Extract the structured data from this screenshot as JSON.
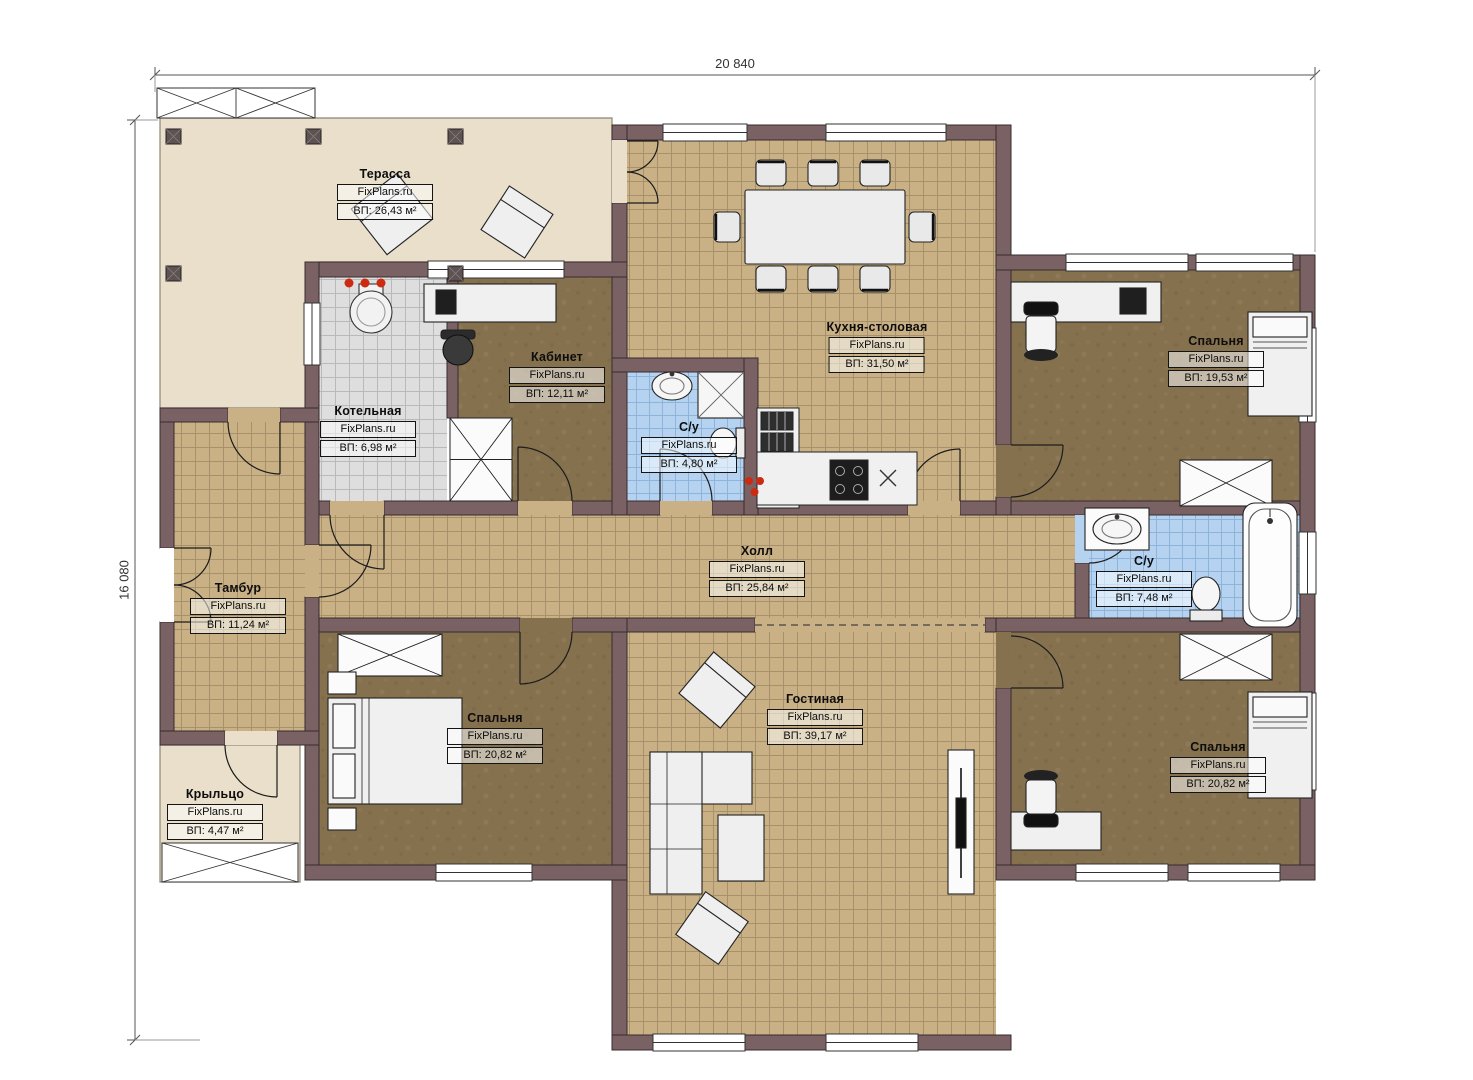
{
  "brand": "FixPlans.ru",
  "dimensions": {
    "width_label": "20 840",
    "height_label": "16 080"
  },
  "palette": {
    "wall": "#7a6164",
    "terrace_floor": "#e9dfcb",
    "tile_floor": "#c9b185",
    "wood_floor": "#86714f",
    "bath_floor": "#b5d3f0",
    "boiler_floor": "#dedede",
    "burner_red": "#cc2b12"
  },
  "rooms": [
    {
      "id": "terrace",
      "name": "Терасса",
      "brand": "FixPlans.ru",
      "area": "ВП: 26,43 м²"
    },
    {
      "id": "boiler",
      "name": "Котельная",
      "brand": "FixPlans.ru",
      "area": "ВП: 6,98 м²"
    },
    {
      "id": "office",
      "name": "Кабинет",
      "brand": "FixPlans.ru",
      "area": "ВП: 12,11 м²"
    },
    {
      "id": "wc-small",
      "name": "С/у",
      "brand": "FixPlans.ru",
      "area": "ВП: 4,80 м²"
    },
    {
      "id": "kitchen",
      "name": "Кухня-столовая",
      "brand": "FixPlans.ru",
      "area": "ВП: 31,50 м²"
    },
    {
      "id": "bedroom-tr",
      "name": "Спальня",
      "brand": "FixPlans.ru",
      "area": "ВП: 19,53 м²"
    },
    {
      "id": "hall",
      "name": "Холл",
      "brand": "FixPlans.ru",
      "area": "ВП: 25,84 м²"
    },
    {
      "id": "wc-big",
      "name": "С/у",
      "brand": "FixPlans.ru",
      "area": "ВП: 7,48 м²"
    },
    {
      "id": "tambur",
      "name": "Тамбур",
      "brand": "FixPlans.ru",
      "area": "ВП: 11,24 м²"
    },
    {
      "id": "bedroom-bl",
      "name": "Спальня",
      "brand": "FixPlans.ru",
      "area": "ВП: 20,82 м²"
    },
    {
      "id": "living",
      "name": "Гостиная",
      "brand": "FixPlans.ru",
      "area": "ВП: 39,17 м²"
    },
    {
      "id": "porch",
      "name": "Крыльцо",
      "brand": "FixPlans.ru",
      "area": "ВП: 4,47 м²"
    },
    {
      "id": "bedroom-br",
      "name": "Спальня",
      "brand": "FixPlans.ru",
      "area": "ВП: 20,82 м²"
    }
  ]
}
